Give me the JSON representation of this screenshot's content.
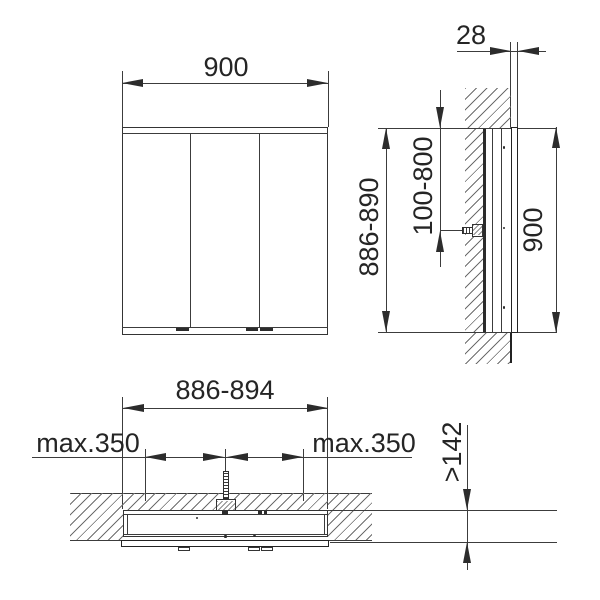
{
  "drawing_type": "installation-dimension-drawing",
  "front_view": {
    "width": "900"
  },
  "side_view": {
    "protrusion_depth": "28",
    "niche_height": "886-890",
    "connection_height_range": "100-800",
    "cabinet_height": "900"
  },
  "plan_view": {
    "niche_width": "886-894",
    "connection_offset_left": "max.350",
    "connection_offset_right": "max.350",
    "min_niche_depth": ">142"
  },
  "colors": {
    "line": "#3c3c3c",
    "dark": "#232323",
    "background": "#ffffff"
  }
}
